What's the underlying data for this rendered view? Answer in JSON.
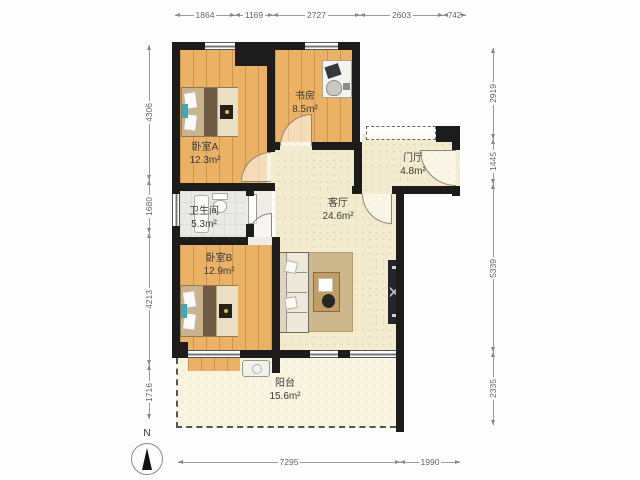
{
  "rooms": {
    "bedroom_a": {
      "name": "卧室A",
      "area": "12.3m²"
    },
    "study": {
      "name": "书房",
      "area": "8.5m²"
    },
    "entrance": {
      "name": "门厅",
      "area": "4.8m²"
    },
    "living": {
      "name": "客厅",
      "area": "24.6m²"
    },
    "bathroom": {
      "name": "卫生间",
      "area": "5.3m²"
    },
    "bedroom_b": {
      "name": "卧室B",
      "area": "12.9m²"
    },
    "balcony": {
      "name": "阳台",
      "area": "15.6m²"
    }
  },
  "dimensions": {
    "top": [
      "1864",
      "1169",
      "2727",
      "2603",
      "742"
    ],
    "left": [
      "4306",
      "1680",
      "4213",
      "1716"
    ],
    "right": [
      "2919",
      "1445",
      "5339",
      "2335"
    ],
    "bottom": [
      "7295",
      "1990"
    ]
  },
  "compass": {
    "label": "N"
  },
  "colors": {
    "wall": "#1c1c1c",
    "wood_floor": "#ebb266",
    "tile_floor": "#f2ebcd",
    "balcony_floor": "#f8f4e0",
    "bathroom_floor": "#e9e9e5",
    "accent_pillow": "#3fa8b8",
    "tv_dot": "#d6c23e"
  }
}
